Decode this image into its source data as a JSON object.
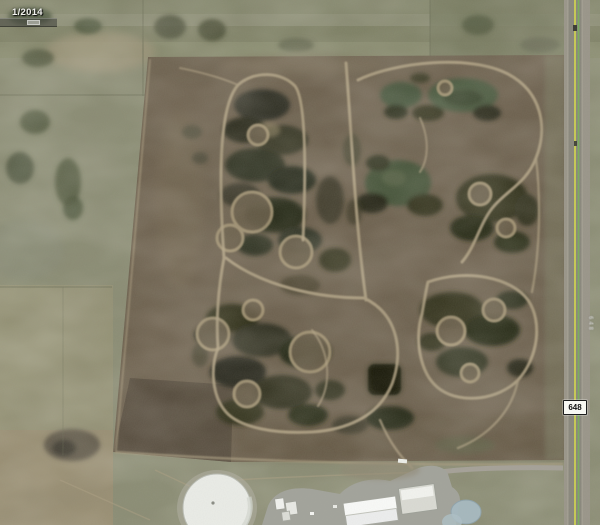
{
  "viewer": {
    "app_context": "historical-satellite-imagery",
    "imagery_date": "1/2014"
  },
  "time_slider": {
    "visible": true
  },
  "road": {
    "shield_label": "648",
    "vertical_label": "648"
  },
  "palette": {
    "farmland_green": "#8d8f77",
    "field_brown": "#6f6351",
    "wetland_dark": "#2c2e1d",
    "pond_green": "#4b5940",
    "pond_blue": "#a7bac1",
    "trail_tan": "#b3a486",
    "road_asphalt": "#8a887d",
    "road_line_yellow": "#d6d94b",
    "road_line_green": "#77b25c",
    "tank_white": "#e9ebe6"
  }
}
